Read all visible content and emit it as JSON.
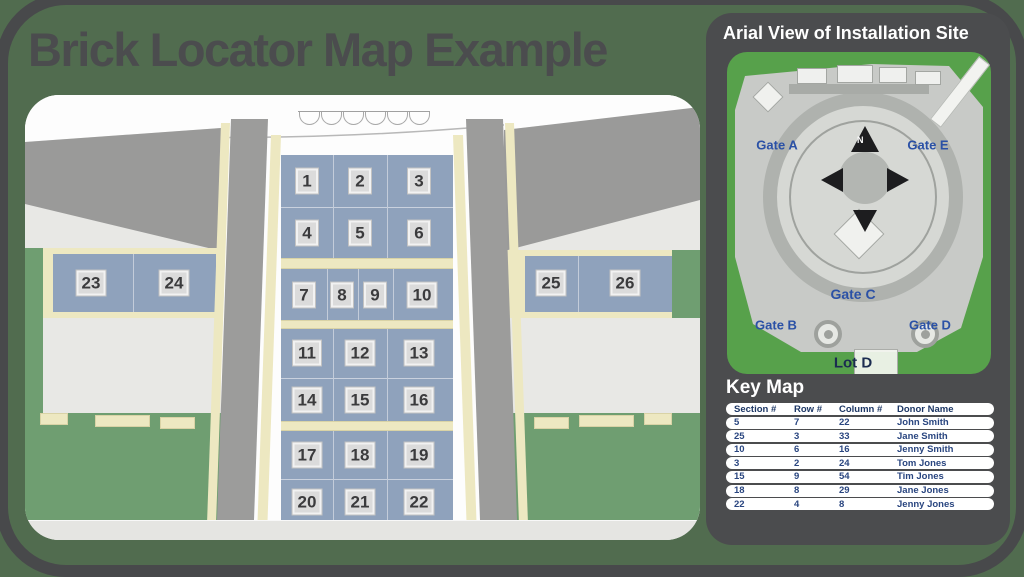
{
  "title": "Brick Locator Map Example",
  "colors": {
    "page_background": "#516C4F",
    "frame": "#48494B",
    "panel": "#4B4C4E",
    "accent_green": "#57A14B",
    "section_blue": "#8FA2BC",
    "walkway_cream": "#EDE8C1",
    "grass_green": "#6F9E71",
    "gate_blue": "#2B51A6",
    "table_navy": "#2A4680"
  },
  "map": {
    "sections": [
      "1",
      "2",
      "3",
      "4",
      "5",
      "6",
      "7",
      "8",
      "9",
      "10",
      "11",
      "12",
      "13",
      "14",
      "15",
      "16",
      "17",
      "18",
      "19",
      "20",
      "21",
      "22"
    ],
    "side_left": [
      "23",
      "24"
    ],
    "side_right": [
      "25",
      "26"
    ]
  },
  "panel": {
    "title": "Arial View of Installation Site",
    "aerial": {
      "gate_a": "Gate A",
      "gate_e": "Gate E",
      "gate_c": "Gate C",
      "gate_b": "Gate B",
      "gate_d": "Gate D",
      "lot_d": "Lot D",
      "compass_north": "N"
    },
    "key_map": {
      "title": "Key Map",
      "columns": [
        "Section #",
        "Row #",
        "Column #",
        "Donor Name"
      ],
      "rows": [
        [
          "5",
          "7",
          "22",
          "John Smith"
        ],
        [
          "25",
          "3",
          "33",
          "Jane Smith"
        ],
        [
          "10",
          "6",
          "16",
          "Jenny Smith"
        ],
        [
          "3",
          "2",
          "24",
          "Tom Jones"
        ],
        [
          "15",
          "9",
          "54",
          "Tim Jones"
        ],
        [
          "18",
          "8",
          "29",
          "Jane Jones"
        ],
        [
          "22",
          "4",
          "8",
          "Jenny Jones"
        ]
      ]
    }
  }
}
